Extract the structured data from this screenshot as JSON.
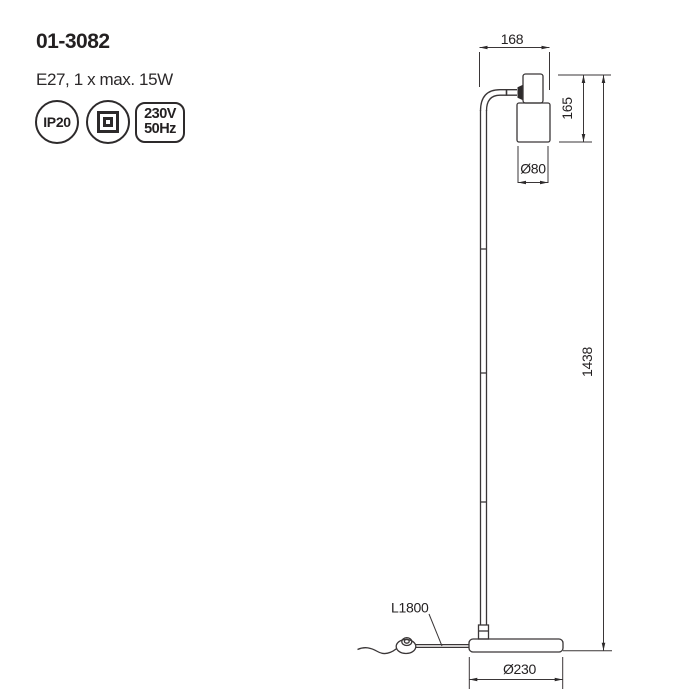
{
  "header": {
    "product_code": "01-3082",
    "lamp_spec": "E27, 1 x max. 15W"
  },
  "badges": {
    "ip_rating": "IP20",
    "voltage": "230V",
    "frequency": "50Hz",
    "class2_symbol": "double-square-insulation-icon"
  },
  "drawing": {
    "dims": {
      "arm_length": "168",
      "head_height": "165",
      "head_diameter": "Ø80",
      "total_height": "1438",
      "cable_length": "L1800",
      "base_diameter": "Ø230"
    }
  },
  "colors": {
    "ink": "#2d2a2b",
    "background": "#ffffff"
  }
}
